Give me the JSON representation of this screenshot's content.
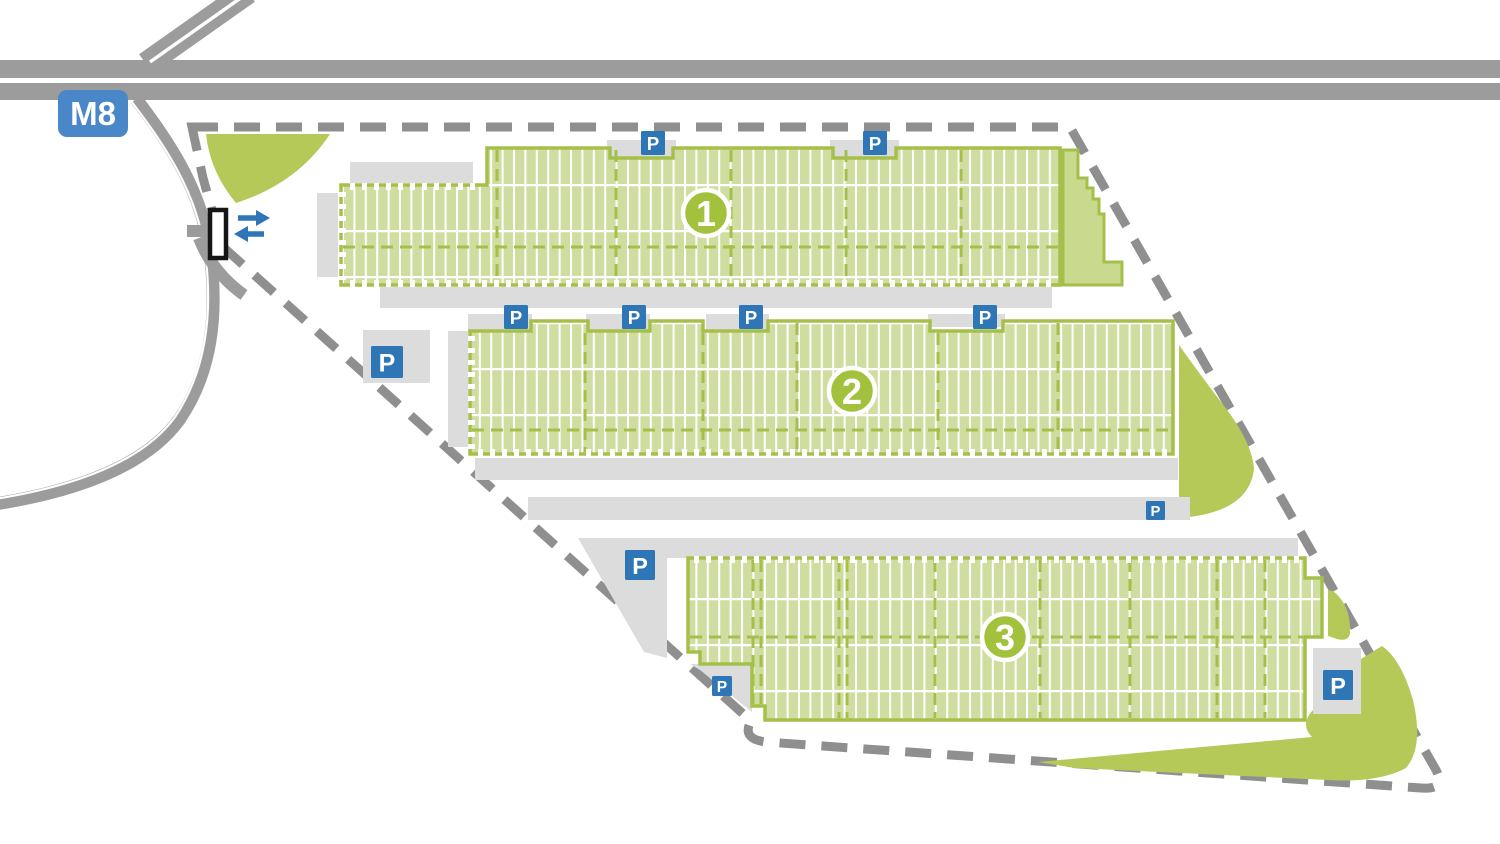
{
  "title": "Logistics park site plan",
  "motorway": {
    "label": "M8"
  },
  "gate": {
    "arrows": [
      "in",
      "out"
    ]
  },
  "buildings": [
    {
      "number": "1",
      "badge": {
        "x": 706,
        "y": 213
      }
    },
    {
      "number": "2",
      "badge": {
        "x": 852,
        "y": 391
      }
    },
    {
      "number": "3",
      "badge": {
        "x": 1005,
        "y": 637
      }
    }
  ],
  "parking": {
    "label": "P",
    "badges": [
      {
        "x": 641,
        "y": 131,
        "size": 24
      },
      {
        "x": 863,
        "y": 131,
        "size": 24
      },
      {
        "x": 504,
        "y": 305,
        "size": 24
      },
      {
        "x": 622,
        "y": 305,
        "size": 24
      },
      {
        "x": 739,
        "y": 305,
        "size": 24
      },
      {
        "x": 973,
        "y": 305,
        "size": 24
      },
      {
        "x": 371,
        "y": 346,
        "size": 32
      },
      {
        "x": 1146,
        "y": 501,
        "size": 19
      },
      {
        "x": 625,
        "y": 550,
        "size": 30
      },
      {
        "x": 712,
        "y": 676,
        "size": 20
      },
      {
        "x": 1323,
        "y": 670,
        "size": 30
      }
    ]
  },
  "colors": {
    "road": "#9c9c9c",
    "boundary_dash": "#8f8f8f",
    "apron": "#dcdcdc",
    "building_fill": "#cfdda0",
    "building_line": "#a5c04a",
    "number_badge": "#a2c13c",
    "landscape_green": "#b4c957",
    "annex_green": "#c9d98d",
    "parking_blue": "#2e76b6",
    "motorway_blue": "#4a87c9"
  }
}
